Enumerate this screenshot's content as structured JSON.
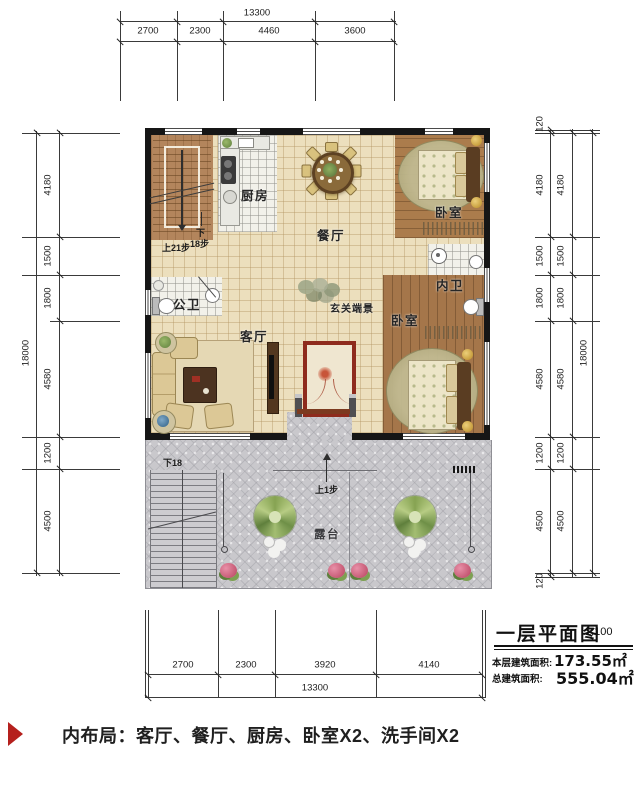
{
  "dims": {
    "top": {
      "total": "13300",
      "segments": [
        "2700",
        "2300",
        "4460",
        "3600"
      ]
    },
    "bottom": {
      "total": "13300",
      "segments": [
        "2700",
        "2300",
        "3920",
        "4140"
      ]
    },
    "left": {
      "total": "18000",
      "segments": [
        "4180",
        "1500",
        "1800",
        "4580",
        "1200",
        "4500"
      ]
    },
    "right": {
      "total": "18000",
      "wall": "120",
      "segments": [
        "4180",
        "1500",
        "1800",
        "4580",
        "1200",
        "4500"
      ]
    }
  },
  "rooms": {
    "kitchen": "厨房",
    "dining": "餐厅",
    "bedroom": "卧室",
    "ensuite": "内卫",
    "public_bath": "公卫",
    "living": "客厅",
    "foyer_view": "玄关端景",
    "terrace": "露台"
  },
  "stairs": {
    "up": "上21步",
    "down_char": "下",
    "down_steps": "18步",
    "terrace_down": "下18",
    "terrace_up": "上1步"
  },
  "title_block": {
    "title": "一层平面图",
    "scale": "1:100",
    "floor_area_label": "本层建筑面积:",
    "floor_area_value": "173.55㎡",
    "total_area_label": "总建筑面积:",
    "total_area_value": "555.04㎡"
  },
  "caption": {
    "text": "内布局：客厅、餐厅、厨房、卧室X2、洗手间X2"
  },
  "colors": {
    "wall": "#161616",
    "accent_red": "#b5201d",
    "beige_tile": "#ecdfbd",
    "wood": "#a97c4e",
    "terrace_gray": "#c9c8cc"
  }
}
